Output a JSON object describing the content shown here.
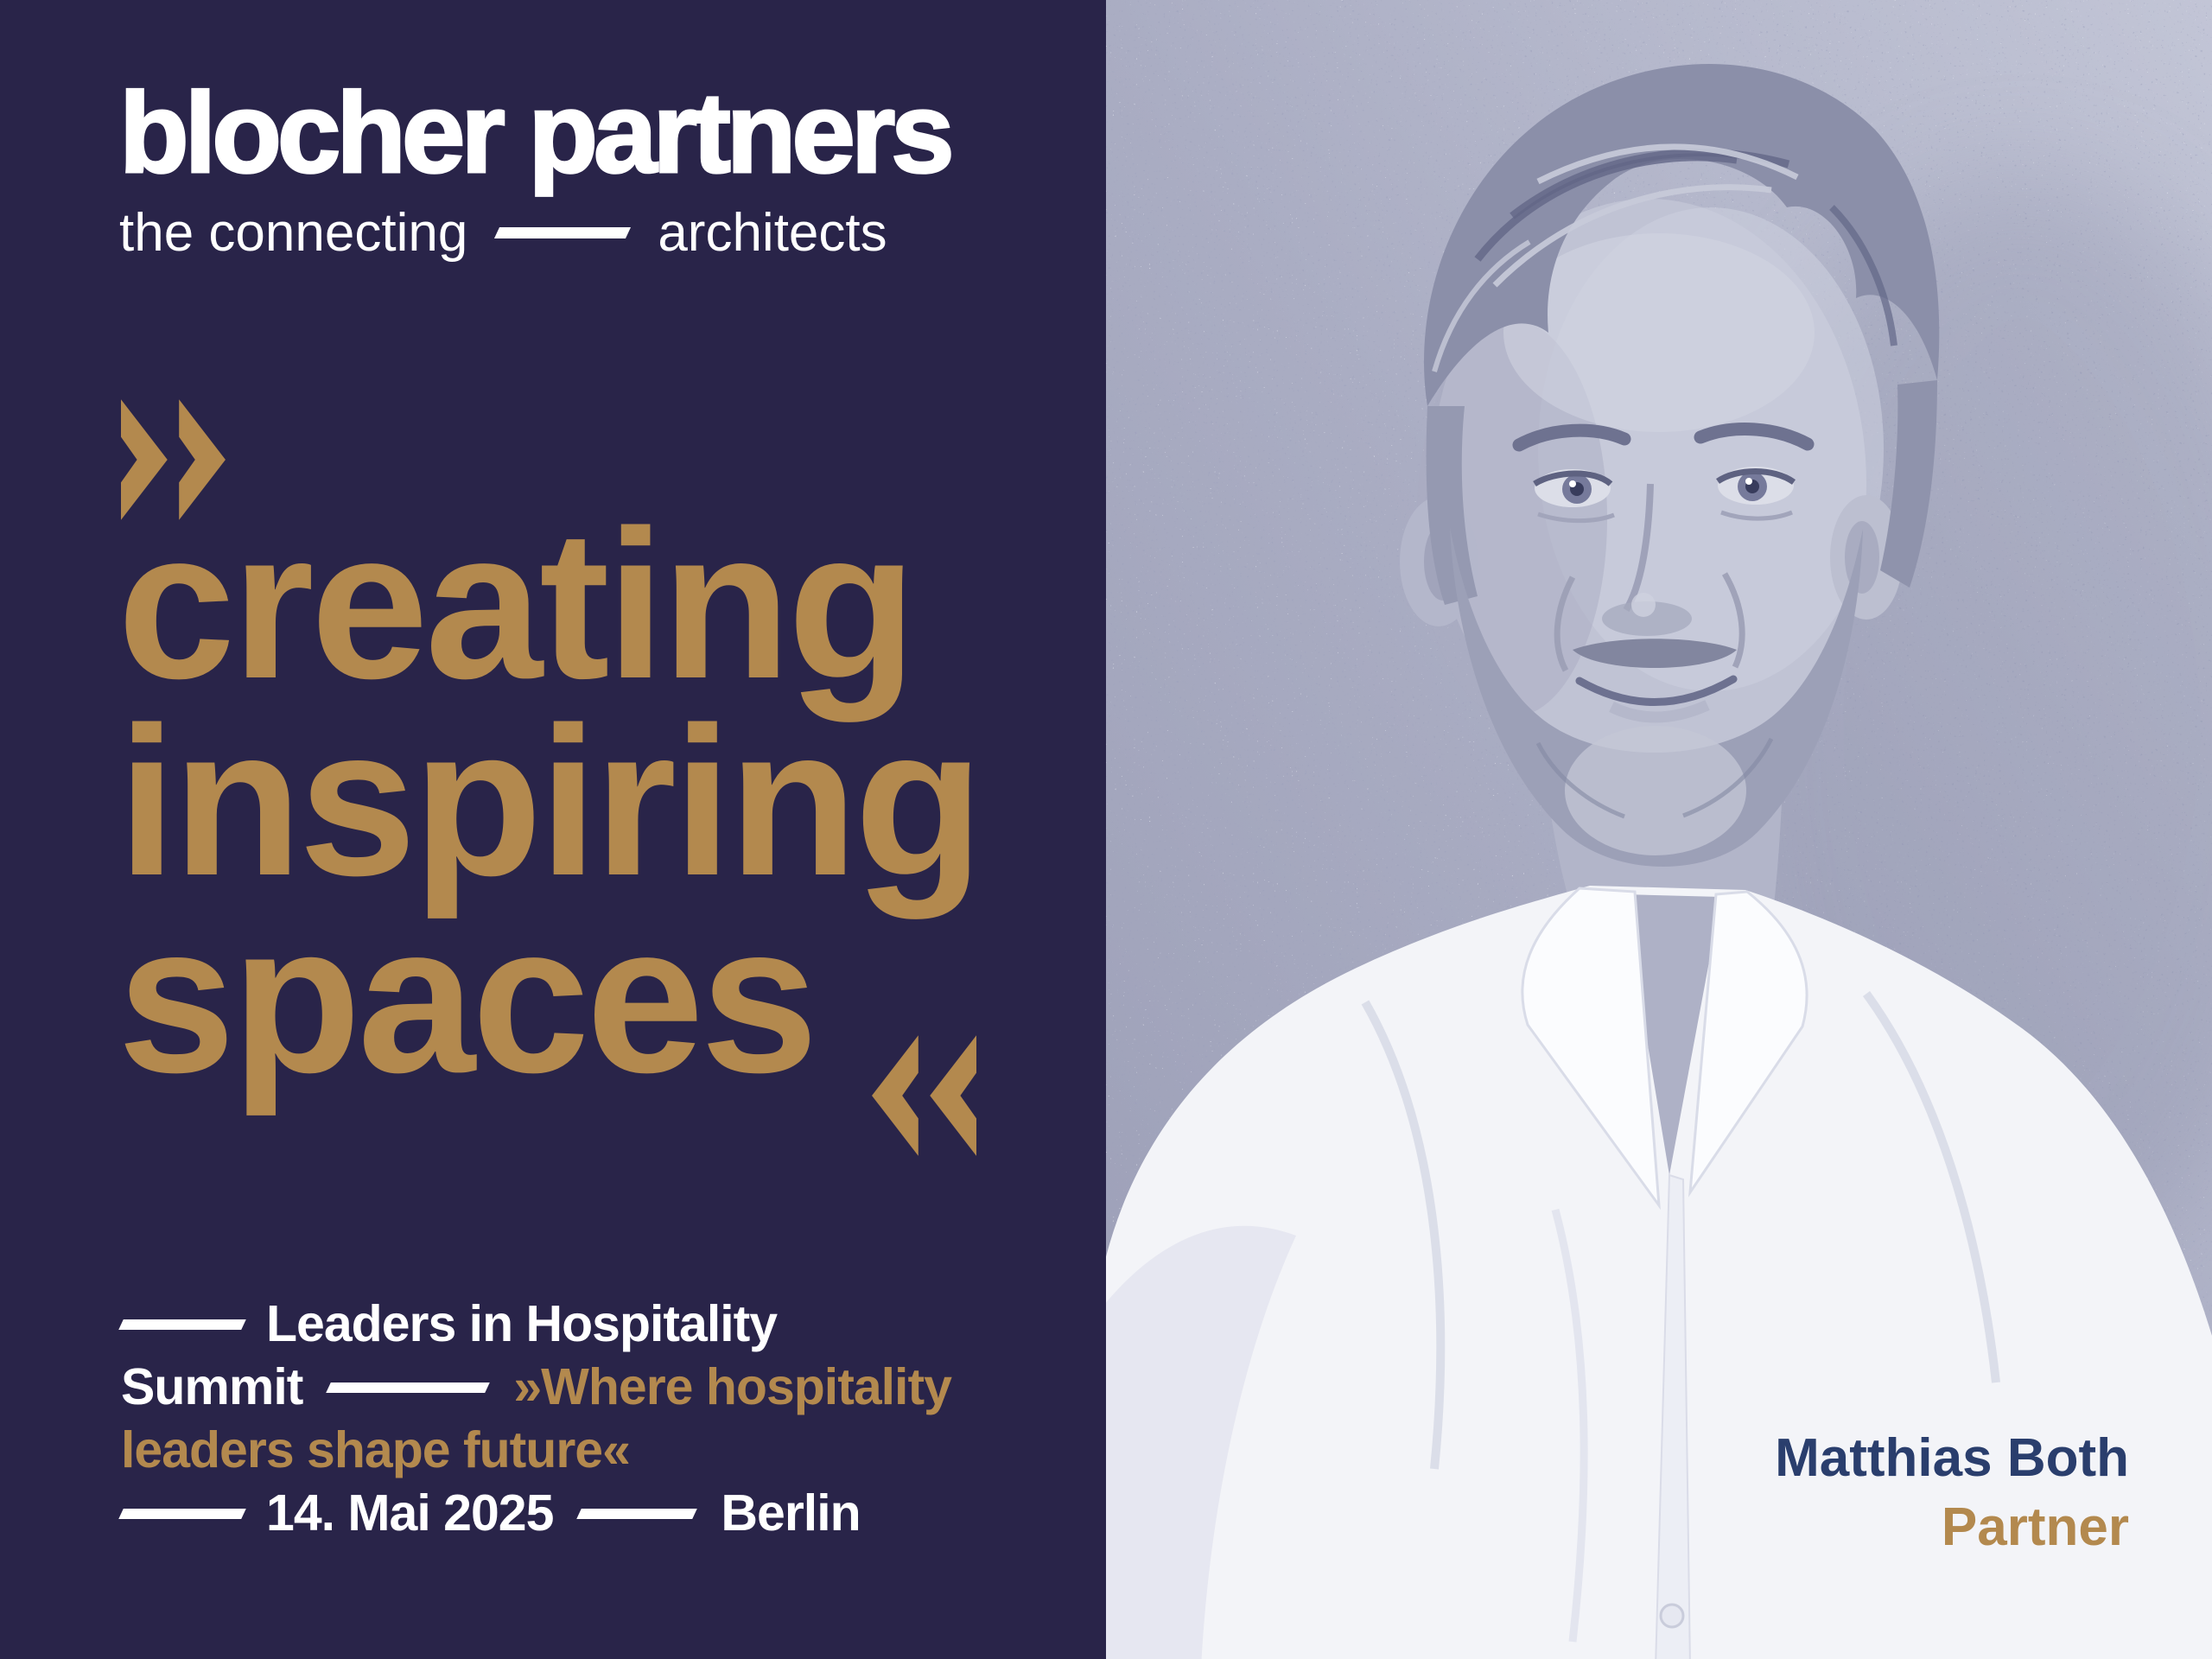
{
  "brand": {
    "name": "blocher partners",
    "tagline_left": "the connecting",
    "tagline_right": "architects"
  },
  "headline": {
    "open_quote": "»",
    "lines": [
      "creating",
      "inspiring",
      "spaces"
    ],
    "close_quote": "«"
  },
  "event": {
    "line1": "Leaders in Hospitality",
    "line2_white": "Summit",
    "line2_gold": "»Where hospitality",
    "line3_gold": "leaders shape future«",
    "date": "14. Mai 2025",
    "city": "Berlin"
  },
  "person": {
    "name": "Matthias Both",
    "role": "Partner"
  },
  "colors": {
    "background_navy": "#292449",
    "accent_gold": "#b3894e",
    "text_white": "#ffffff",
    "person_name_navy": "#2a3e6d",
    "wall_grey": "#aaadc3"
  }
}
